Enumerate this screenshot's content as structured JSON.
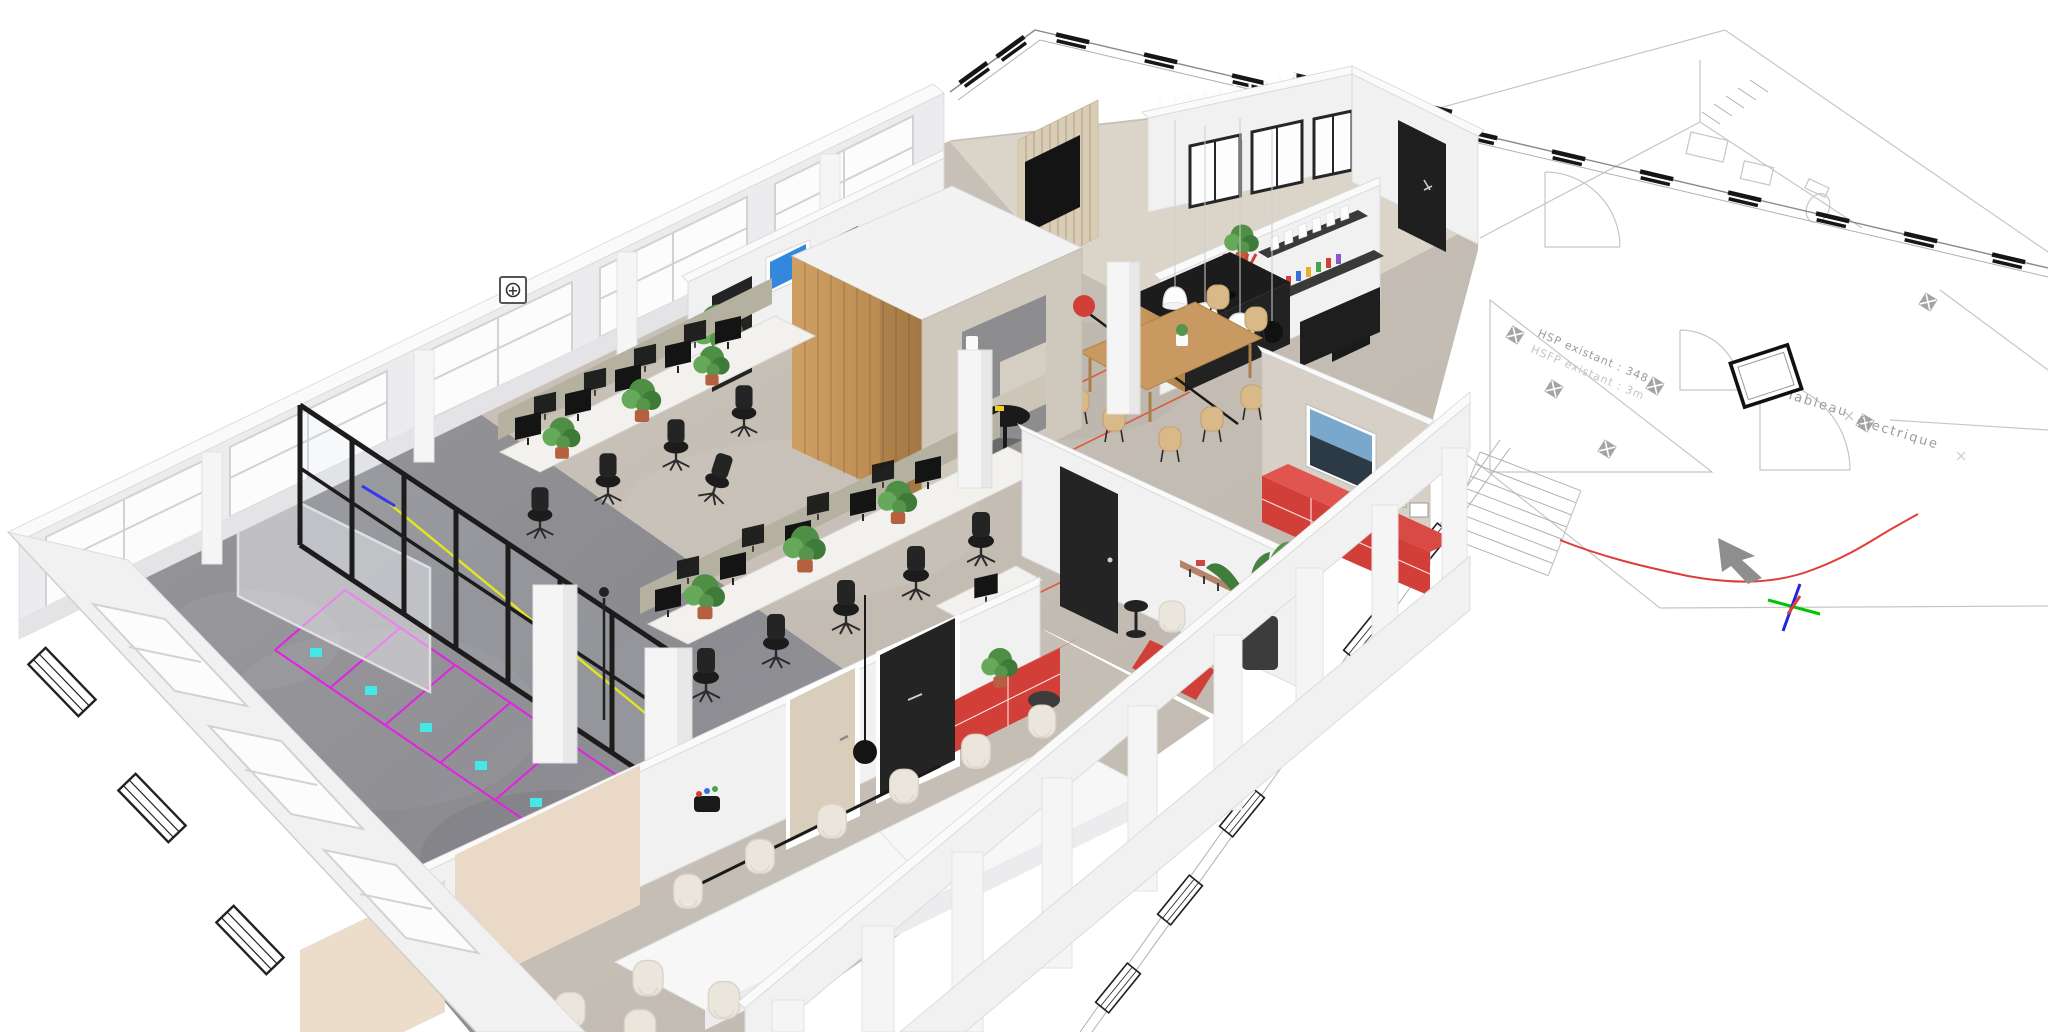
{
  "scene": {
    "type": "3d-floorplan-render",
    "description": "Axonometric 3D render of an office fit-out placed over a 2D CAD architectural drawing on a white background",
    "background": "#ffffff"
  },
  "cad": {
    "labels": {
      "tableau_line1": "Tableau",
      "tableau_line2": "électrique",
      "hsp": "HSP existant : 348",
      "hsfp": "HSFP existant : 3m"
    },
    "colors": {
      "line": "#c6c6c6",
      "line_dark": "#8a8a8a",
      "text": "#9b9b9b",
      "text_light": "#c4c4c4",
      "window_symbol": "#161616",
      "red_spline": "#e03c38",
      "north_arrow": "#8e8e8e"
    },
    "axes": {
      "green": "#00c400",
      "blue": "#2424e6",
      "red": "#e03c38"
    }
  },
  "model": {
    "palette": {
      "wall_white": "#f1f1f2",
      "floor_concrete": "#8f8f93",
      "floor_screed": "#c7c0b7",
      "floor_tile": "#ddd6cb",
      "wood": "#c89a62",
      "greige_wall": "#d6d0c6",
      "divider_olive": "#b5b1a0",
      "red_furniture": "#d23f38",
      "red_furniture_top": "#e05550",
      "magenta": "#e520e5",
      "cyan": "#45e8e8",
      "yellow": "#e8e800",
      "blue_line": "#2222ee",
      "orange_line": "#e0593a",
      "pinboard_beige": "#ead9c6",
      "door_beige": "#d9cdbc",
      "door_black": "#242424",
      "cream_chair": "#eae6db",
      "chair_black": "#1c1c1c",
      "plant_green": "#4e8f45",
      "tv_blue": "#3388dd",
      "frame_black": "#1c1c1c"
    },
    "legend": {
      "rooms": [
        "storage-room-concrete",
        "open-office",
        "meeting-pod",
        "kitchen",
        "dining-area",
        "lounge",
        "conference-room"
      ],
      "cad_symbols": [
        "window-symbol",
        "light-fixture-symbol",
        "door-swing-arc",
        "stairs",
        "north-arrow",
        "origin-axes",
        "electrical-panel"
      ]
    }
  },
  "ui": {
    "section_marker": {
      "glyph": "+"
    }
  }
}
